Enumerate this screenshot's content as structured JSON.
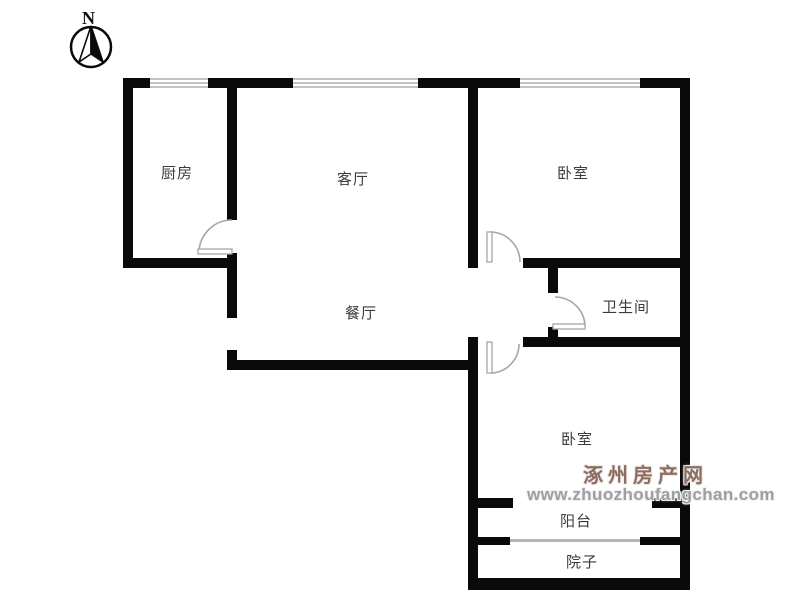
{
  "compass": {
    "label": "N"
  },
  "rooms": [
    {
      "id": "kitchen",
      "label": "厨房"
    },
    {
      "id": "living-room",
      "label": "客厅"
    },
    {
      "id": "bedroom-north",
      "label": "卧室"
    },
    {
      "id": "dining-room",
      "label": "餐厅"
    },
    {
      "id": "bathroom",
      "label": "卫生间"
    },
    {
      "id": "bedroom-south",
      "label": "卧室"
    },
    {
      "id": "balcony",
      "label": "阳台"
    },
    {
      "id": "yard",
      "label": "院子"
    }
  ],
  "watermark": {
    "site_name": "涿州房产网",
    "site_url": "www.zhuozhoufangchan.com"
  },
  "colors": {
    "wall": "#0a0a0a",
    "room_label": "#3c3c3c",
    "window_symbol": "#c3c3c3",
    "door_symbol": "#a6a6a6",
    "watermark_name": "#8c6d60",
    "watermark_url": "#9e9e9e",
    "background": "#ffffff"
  }
}
